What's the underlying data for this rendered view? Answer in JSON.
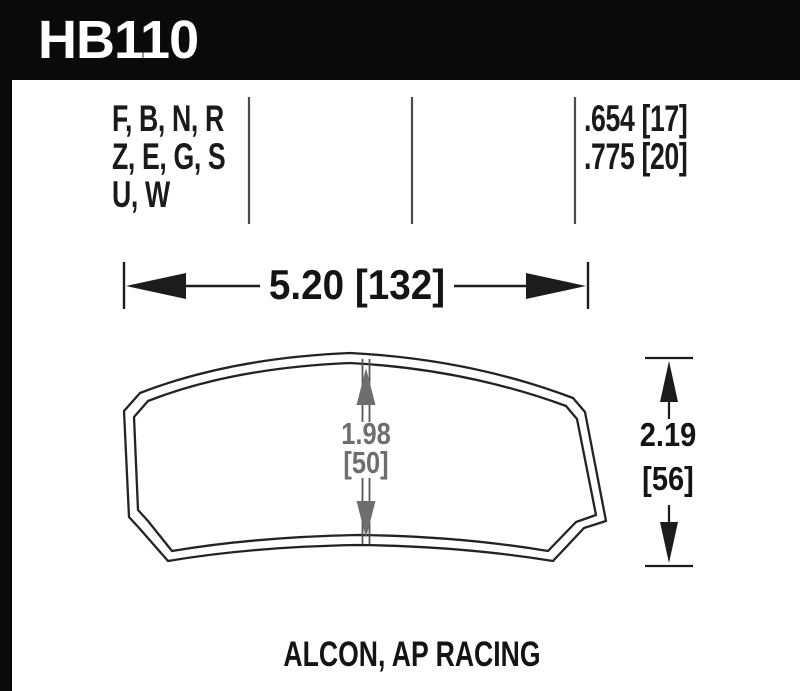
{
  "header": {
    "part_number": "HB110"
  },
  "spec_table": {
    "compound_rows": [
      "F, B, N, R",
      "Z, E, G, S",
      "U, W"
    ],
    "value_rows": [
      ".654 [17]",
      ".775 [20]"
    ]
  },
  "dimensions": {
    "width_label": "5.20 [132]",
    "pad_height": {
      "line1": "1.98",
      "line2": "[50]"
    },
    "overall_height": {
      "line1": "2.19",
      "line2": "[56]"
    }
  },
  "footer": {
    "applications": "ALCON, AP RACING"
  },
  "colors": {
    "header_bg": "#0a0a0b",
    "ink": "#1c1c1e",
    "dim_gray": "#6d6e71",
    "divider_gray": "#4c4c4e",
    "background": "#ffffff"
  }
}
